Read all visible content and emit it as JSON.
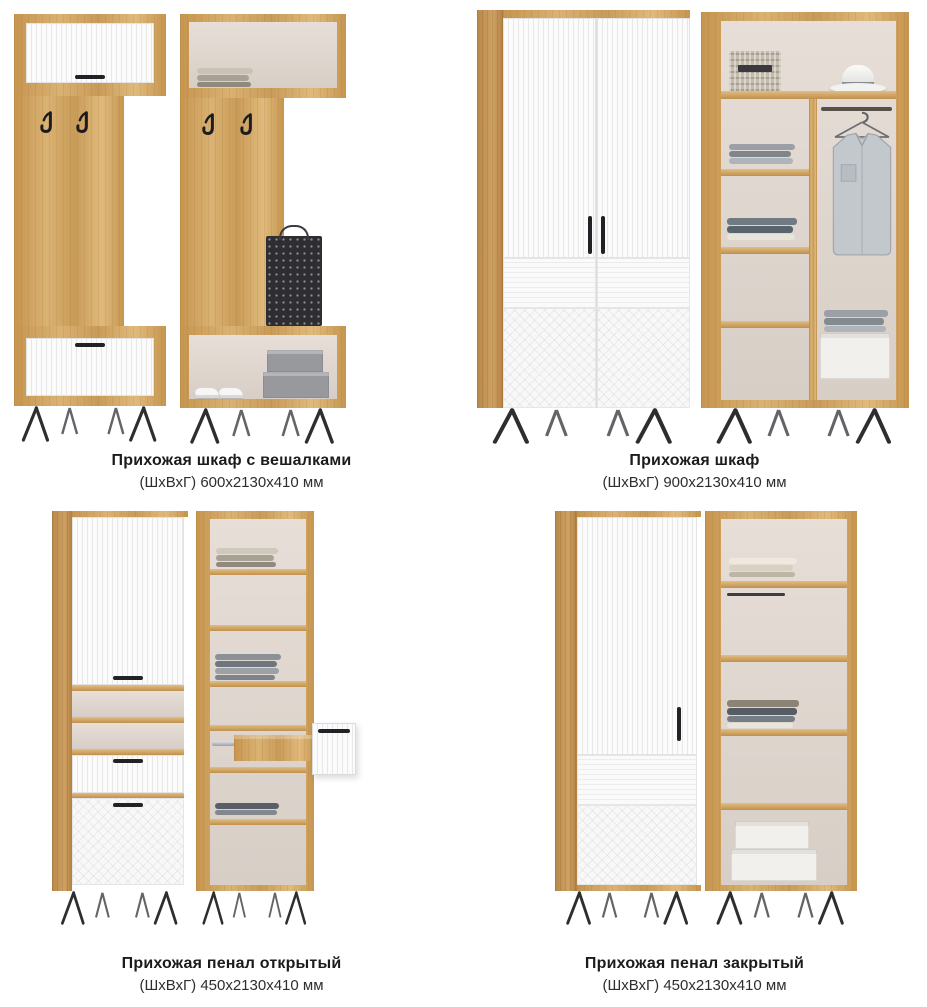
{
  "products": [
    {
      "name": "Прихожая шкаф с вешалками",
      "dimensions": "(ШхВхГ) 600х2130х410 мм"
    },
    {
      "name": "Прихожая шкаф",
      "dimensions": "(ШхВхГ) 900х2130х410 мм"
    },
    {
      "name": "Прихожая пенал открытый",
      "dimensions": "(ШхВхГ) 450х2130х410 мм"
    },
    {
      "name": "Прихожая пенал закрытый",
      "dimensions": "(ШхВхГ) 450х2130х410 мм"
    }
  ],
  "colors": {
    "background": "#ffffff",
    "wood_oak": "#cfa263",
    "front_white": "#f7f7f7",
    "interior_back": "#ded5cd",
    "metal_black": "#26262a",
    "text": "#1b1b1b"
  }
}
